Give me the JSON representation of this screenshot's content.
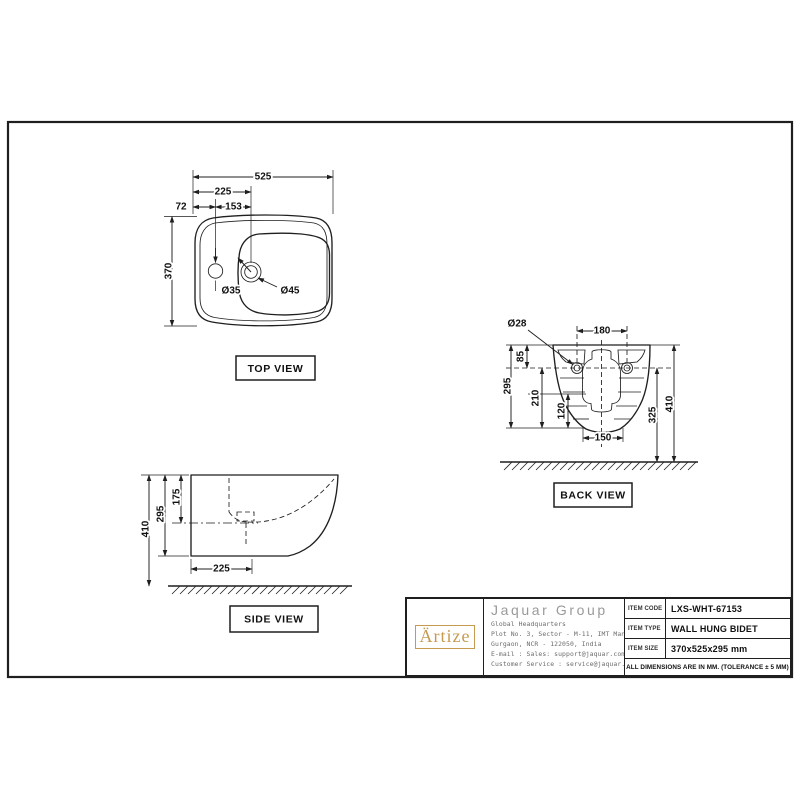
{
  "colors": {
    "line": "#1f1f1f",
    "logo_gold": "#c79a52",
    "company_gray": "#9a9a9a"
  },
  "views": {
    "top": {
      "label": "TOP VIEW",
      "dims": {
        "overall_width": "525",
        "left_to_drain": "225",
        "left_to_tap": "72",
        "tap_to_drain": "153",
        "overall_depth": "370",
        "tap_hole_dia": "Ø35",
        "drain_dia": "Ø45"
      }
    },
    "back": {
      "label": "BACK VIEW",
      "dims": {
        "mount_hole_dia": "Ø28",
        "mount_hole_spacing": "180",
        "top_to_holes": "85",
        "body_height": "295",
        "holes_to_bottom": "210",
        "bottom_segment": "120",
        "outlet_width": "150",
        "floor_to_holes": "325",
        "floor_to_top": "410"
      }
    },
    "side": {
      "label": "SIDE VIEW",
      "dims": {
        "floor_to_top": "410",
        "body_height": "295",
        "top_to_basin": "175",
        "base_depth": "225"
      }
    }
  },
  "title_block": {
    "logo_text": "Ärtize",
    "company": "Jaquar Group",
    "address_lines": [
      "Global Headquarters",
      "Plot No. 3, Sector - M-11, IMT Manesar",
      "Gurgaon, NCR - 122050, India",
      "E-mail : Sales: support@jaquar.com",
      "Customer Service : service@jaquar.com"
    ],
    "rows": [
      {
        "label": "ITEM CODE",
        "value": "LXS-WHT-67153"
      },
      {
        "label": "ITEM TYPE",
        "value": "WALL HUNG BIDET"
      },
      {
        "label": "ITEM SIZE",
        "value": "370x525x295 mm"
      }
    ],
    "note": "ALL DIMENSIONS ARE IN MM. (TOLERANCE ± 5 MM)"
  }
}
